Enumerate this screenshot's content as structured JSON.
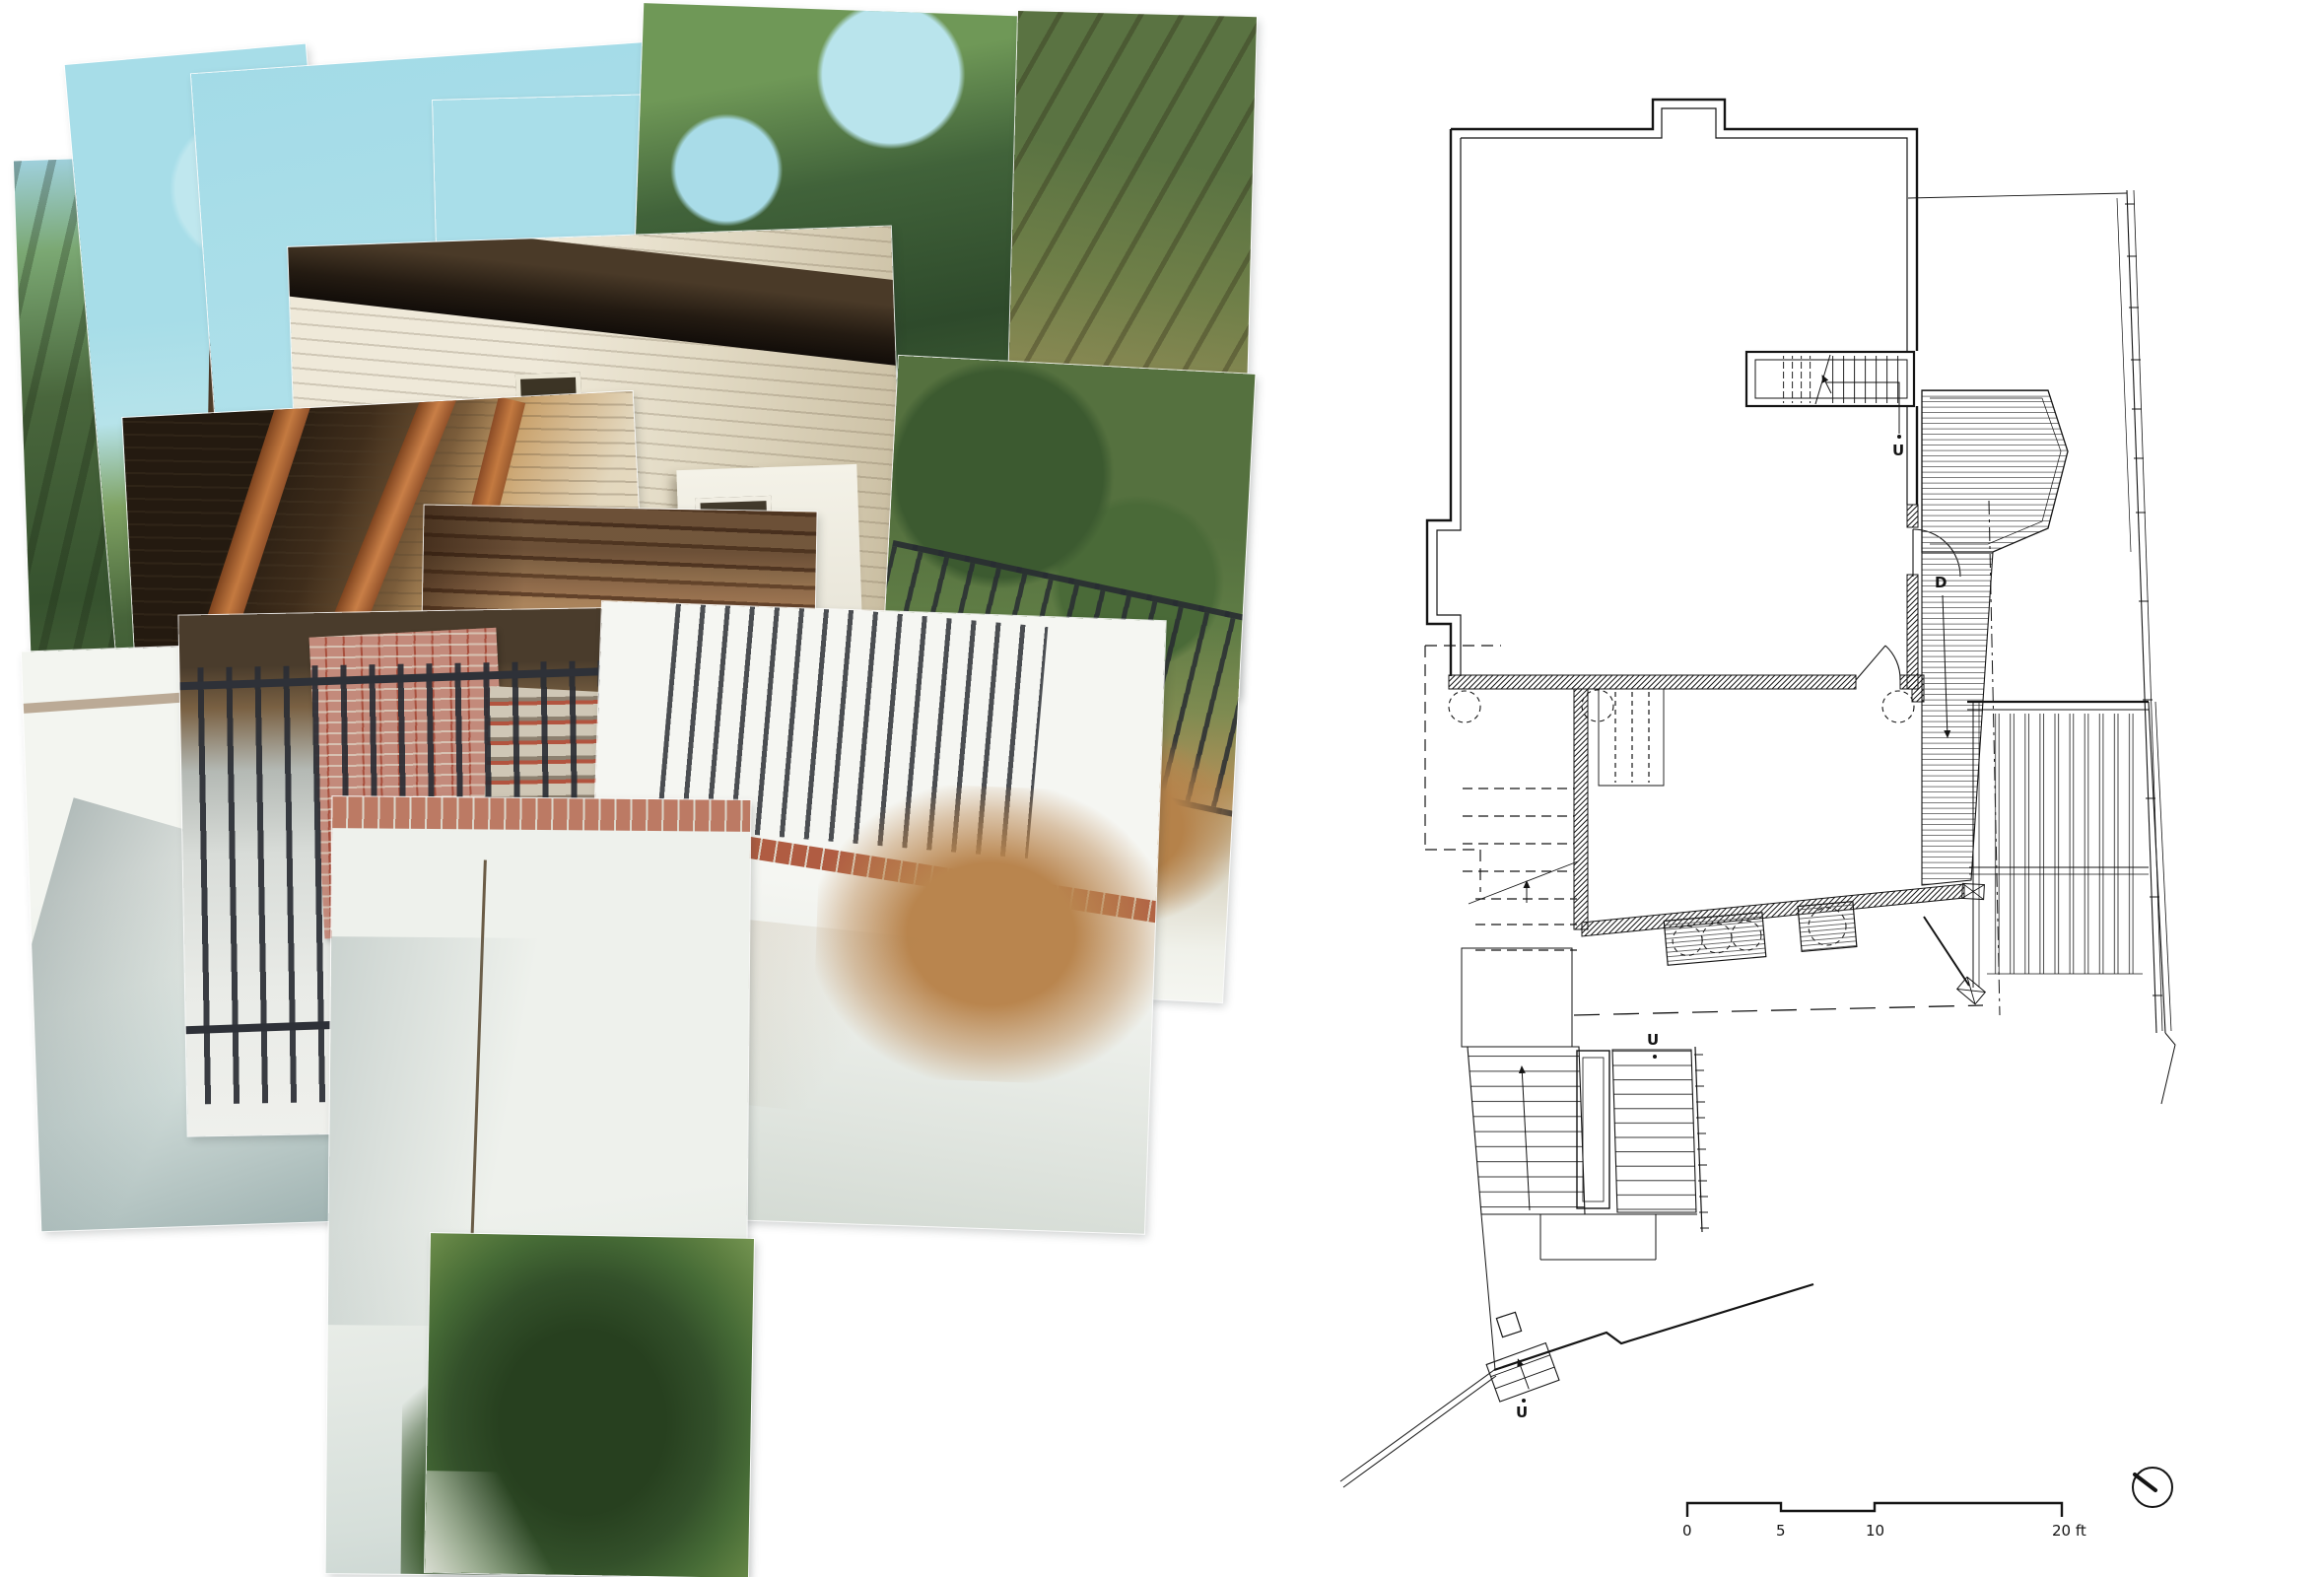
{
  "page": {
    "background": "#ffffff"
  },
  "collage": {
    "palette": {
      "sky": "#aadee9",
      "foliage_dark": "#2e4a2b",
      "foliage_light": "#7b9a55",
      "siding_cream": "#e9e4d3",
      "eave_dark": "#241b13",
      "brace_wood": "#c07a42",
      "timber_cribbing": "#b98a5c",
      "door_green": "#3f5a41",
      "iron_fence": "#33363c",
      "brick": "#a8503e",
      "stucco": "#eef1ec",
      "ivy": "#2f4a28"
    }
  },
  "plan": {
    "ink": "#141414",
    "labels": {
      "interior_stair_up": "U",
      "deck_down": "D",
      "exterior_stair_up": "U",
      "lower_stair_up": "U"
    },
    "scale_bar": {
      "tick_0": "0",
      "tick_5": "5",
      "tick_10": "10",
      "tick_20": "20 ft"
    }
  }
}
